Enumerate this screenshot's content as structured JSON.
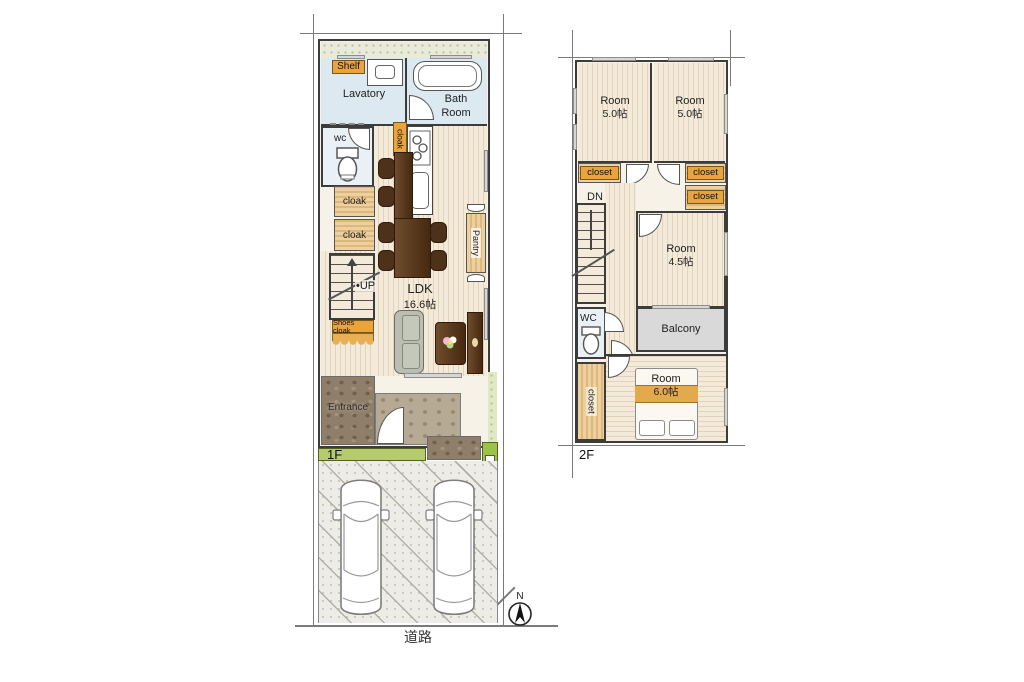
{
  "floor1": {
    "floor_label": "1F",
    "shelf_label": "Shelf",
    "lavatory_label": "Lavatory",
    "bath_room_label": "Bath Room",
    "wc_label": "wc",
    "kitchen_cloak_label": "cloak",
    "cloak_upper_label": "cloak",
    "cloak_lower_label": "cloak",
    "up_label": "•UP",
    "ldk_name": "LDK",
    "ldk_size": "16.6帖",
    "pantry_label": "Pantry",
    "shoes_cloak_label": "Shoes cloak",
    "entrance_label": "Entrance"
  },
  "floor2": {
    "floor_label": "2F",
    "dn_label": "DN",
    "wc_label": "WC",
    "balcony_label": "Balcony",
    "rooms": [
      {
        "name": "Room",
        "size": "5.0帖"
      },
      {
        "name": "Room",
        "size": "5.0帖"
      },
      {
        "name": "Room",
        "size": "4.5帖"
      },
      {
        "name": "Room",
        "size": "6.0帖"
      }
    ],
    "closets": [
      "closet",
      "closet",
      "closet",
      "closet"
    ]
  },
  "site": {
    "road_label": "道路",
    "compass_north_label": "N"
  },
  "colors": {
    "water_room": "#dde9f1",
    "closet_wood": "#e7c893",
    "label_orange": "#e9a43e",
    "floor_light": "#f3ead9",
    "floor_stripe": "#e3d3bb",
    "balcony_gray": "#d9d9d9",
    "grass_green": "#b6cb6e",
    "wall": "#3c3c3c"
  }
}
